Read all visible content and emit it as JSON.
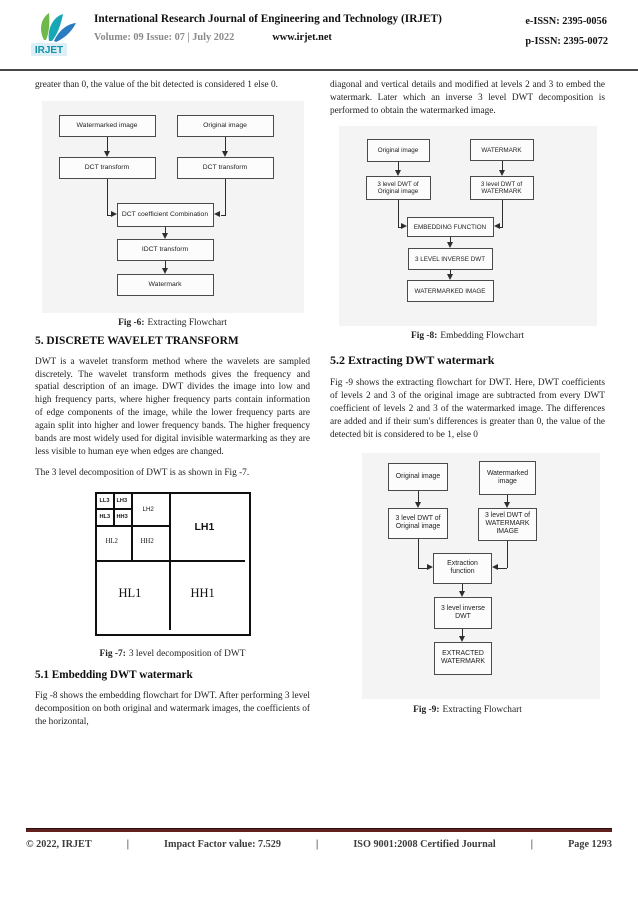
{
  "header": {
    "logo_text": "IRJET",
    "title": "International Research Journal of Engineering and Technology (IRJET)",
    "volume": "Volume: 09 Issue: 07 | July 2022",
    "website": "www.irjet.net",
    "eissn": "e-ISSN: 2395-0056",
    "pissn": "p-ISSN: 2395-0072"
  },
  "left_column": {
    "intro_text": "greater than 0, the value of the bit detected is considered 1 else 0.",
    "fig6": {
      "watermarked_image": "Watermarked image",
      "original_image": "Original image",
      "dct_left": "DCT transform",
      "dct_right": "DCT transform",
      "combination": "DCT coefficient Combination",
      "idct": "IDCT transform",
      "watermark": "Watermark",
      "caption_label": "Fig -6:",
      "caption_text": "Extracting Flowchart"
    },
    "section5_heading": "5. DISCRETE WAVELET TRANSFORM",
    "section5_para": "DWT is a wavelet transform method where the wavelets are sampled discretely. The wavelet transform methods gives the frequency and spatial description of an image. DWT divides the image into low and high frequency parts, where higher frequency parts contain information of edge components of the image, while the lower frequency parts are again split into higher and lower frequency bands. The higher frequency bands are most widely used for digital invisible watermarking as they are less visible to human eye when edges are changed.",
    "fig7_intro": "The 3 level decomposition of DWT is as shown in Fig -7.",
    "fig7": {
      "ll3": "LL3",
      "lh3": "LH3",
      "hl3": "HL3",
      "hh3": "HH3",
      "lh2": "LH2",
      "hl2": "HL2",
      "hh2": "HH2",
      "lh1": "LH1",
      "hl1": "HL1",
      "hh1": "HH1",
      "caption_label": "Fig -7:",
      "caption_text": "3 level decomposition of DWT"
    },
    "section51_heading": "5.1 Embedding DWT watermark",
    "section51_para": "Fig -8 shows the embedding flowchart for DWT. After performing 3 level decomposition on both original and watermark images, the coefficients of the horizontal,"
  },
  "right_column": {
    "top_para": "diagonal and vertical details and modified at levels 2 and 3 to embed the watermark. Later which an inverse 3 level DWT decomposition is performed to obtain the watermarked image.",
    "fig8": {
      "original_image": "Original image",
      "watermark": "WATERMARK",
      "dwt_original": "3 level DWT of Original image",
      "dwt_watermark": "3 level DWT of WATERMARK",
      "embedding_function": "EMBEDDING FUNCTION",
      "inverse_dwt": "3 LEVEL INVERSE DWT",
      "watermarked_image": "WATERMARKED IMAGE",
      "caption_label": "Fig -8:",
      "caption_text": "Embedding Flowchart"
    },
    "section52_heading": "5.2 Extracting DWT watermark",
    "section52_para": "Fig -9 shows the extracting flowchart for DWT. Here, DWT coefficients of levels 2 and 3 of the original image are subtracted from every DWT coefficient of levels 2 and 3 of the watermarked image. The differences are added and if their sum's differences is greater than 0, the value of the detected bit is considered to be 1, else 0",
    "fig9": {
      "original_image": "Original image",
      "watermarked_image": "Watermarked image",
      "dwt_original": "3 level DWT of Original image",
      "dwt_watermark": "3 level DWT of WATERMARK IMAGE",
      "extraction_function": "Extraction function",
      "inverse_dwt": "3 level inverse DWT",
      "extracted_watermark": "EXTRACTED WATERMARK",
      "caption_label": "Fig -9:",
      "caption_text": "Extracting Flowchart"
    }
  },
  "footer": {
    "copyright": "© 2022, IRJET",
    "separator": "|",
    "impact": "Impact Factor value: 7.529",
    "iso": "ISO 9001:2008 Certified Journal",
    "page": "Page 1293"
  }
}
